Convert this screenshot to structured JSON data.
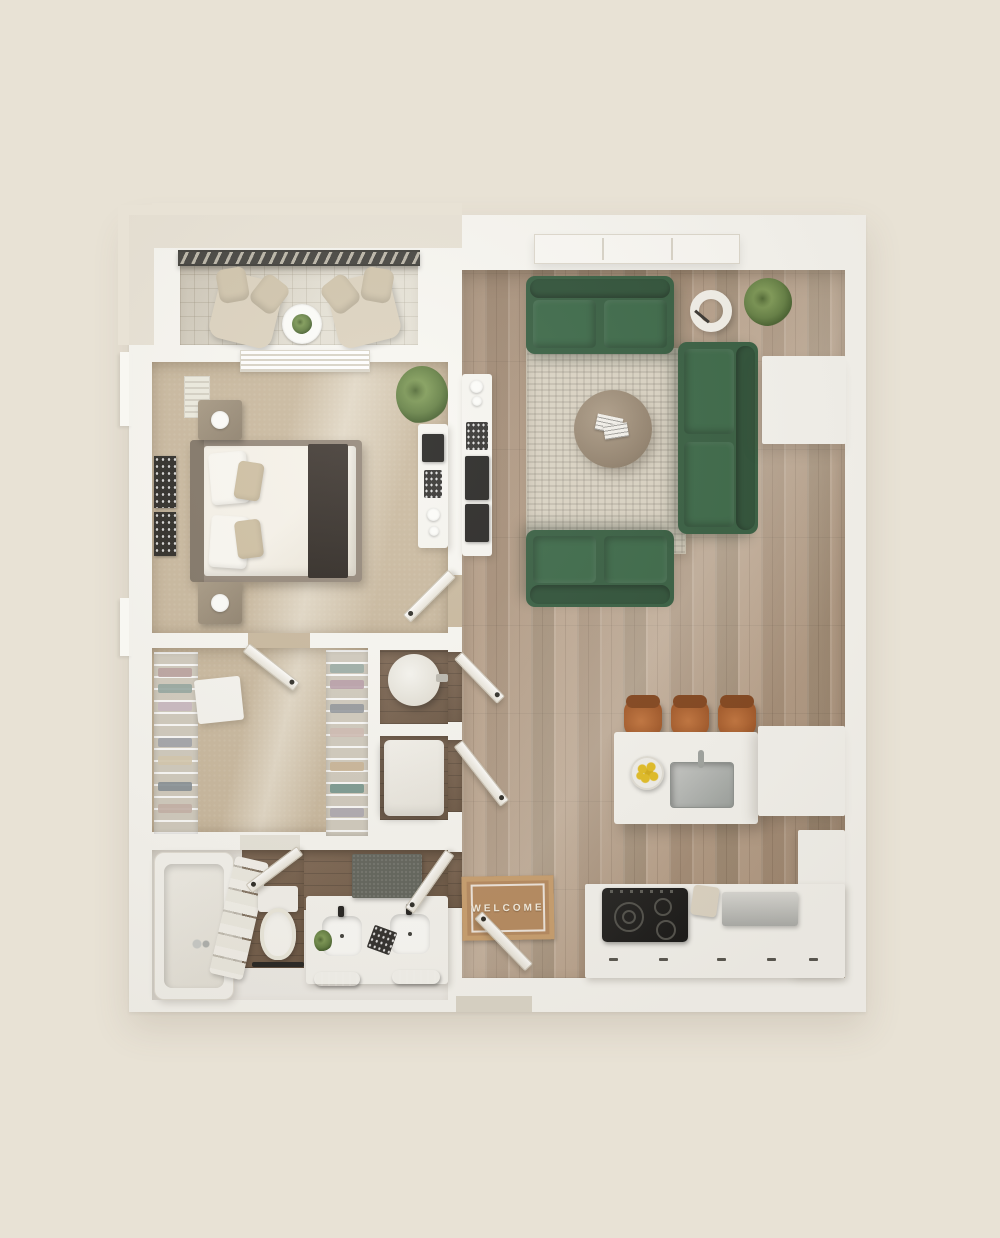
{
  "scene": {
    "description": "3D rendered top-down floor plan of a one-bedroom apartment",
    "entry_mat_text": "WELCOME"
  },
  "rooms": [
    {
      "name": "balcony",
      "furniture": [
        "railing",
        "lounge chair",
        "lounge chair",
        "round side table",
        "potted plant"
      ]
    },
    {
      "name": "bedroom",
      "furniture": [
        "double bed",
        "white duvet",
        "dark throw blanket",
        "pillows",
        "nightstand with lamp",
        "nightstand with lamp",
        "wall art",
        "radiator",
        "window grille",
        "desk with laptop and accessories",
        "potted plant",
        "door"
      ]
    },
    {
      "name": "walk-in-closet",
      "furniture": [
        "wire shelving with clothes",
        "wire shelving with clothes",
        "dresser",
        "door"
      ]
    },
    {
      "name": "utility-niche",
      "furniture": [
        "water heater",
        "door"
      ]
    },
    {
      "name": "laundry-niche",
      "furniture": [
        "washer",
        "door"
      ]
    },
    {
      "name": "bathroom",
      "furniture": [
        "bathtub with faucet",
        "towel ladder",
        "toilet",
        "double vanity",
        "sink",
        "sink",
        "black faucets",
        "vase plant",
        "soap tray",
        "towels",
        "dark bath mat",
        "door",
        "door"
      ]
    },
    {
      "name": "entry",
      "furniture": [
        "welcome mat",
        "entry door"
      ]
    },
    {
      "name": "living-room",
      "furniture": [
        "triple window",
        "green sofa",
        "green sofa",
        "green sofa",
        "patterned area rug",
        "round wood coffee table",
        "magazines",
        "arc floor lamp",
        "potted plant",
        "tv console with speakers",
        "storage block"
      ]
    },
    {
      "name": "kitchen",
      "furniture": [
        "island with sink and faucet",
        "bowl of lemons",
        "bar stool",
        "bar stool",
        "bar stool",
        "black cooktop",
        "cutting board",
        "stainless tray",
        "base cabinets with handles",
        "tall cabinet / fridge",
        "side counter"
      ]
    }
  ],
  "colors": {
    "bg": "#e8e2d5",
    "wall": "#f8f7f2",
    "wood": "#ab947e",
    "wood-dark": "#6f5945",
    "carpet": "#c7b69b",
    "tile": "#dcd7c9",
    "rug": "#d9d2c2",
    "sofa": "#2c5638",
    "sofa-dark": "#23482e",
    "cognac": "#b2602c",
    "lemon": "#e3bd1d",
    "mat": "#b5885c",
    "rail": "#3b3a36",
    "cooktop": "#161616",
    "chrome": "#b7bab8",
    "plant-green": "#5d7a3c"
  }
}
